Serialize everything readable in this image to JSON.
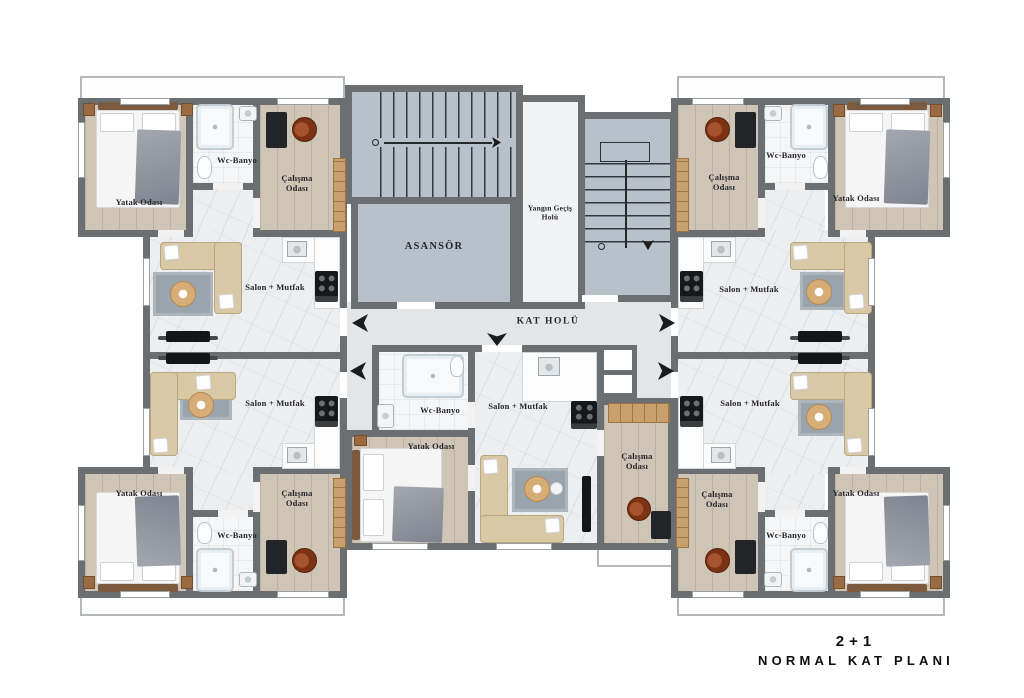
{
  "title": {
    "line1": "2+1",
    "line2": "NORMAL KAT PLANI"
  },
  "core": {
    "elevator": "ASANSÖR",
    "fire_escape_hall": "Yangın Geçiş Holü",
    "floor_hall": "KAT HOLÜ"
  },
  "room_labels": {
    "bedroom": "Yatak Odası",
    "bathroom": "Wc-Banyo",
    "study": "Çalışma Odası",
    "living_kitchen": "Salon + Mutfak"
  },
  "apartments": [
    {
      "position": "top-left",
      "type": "2+1",
      "rooms": [
        "Yatak Odası",
        "Wc-Banyo",
        "Çalışma Odası",
        "Salon + Mutfak"
      ]
    },
    {
      "position": "top-right",
      "type": "2+1",
      "rooms": [
        "Yatak Odası",
        "Wc-Banyo",
        "Çalışma Odası",
        "Salon + Mutfak"
      ]
    },
    {
      "position": "bottom-left",
      "type": "2+1",
      "rooms": [
        "Yatak Odası",
        "Wc-Banyo",
        "Çalışma Odası",
        "Salon + Mutfak"
      ]
    },
    {
      "position": "bottom-center",
      "type": "2+1",
      "rooms": [
        "Yatak Odası",
        "Wc-Banyo",
        "Çalışma Odası",
        "Salon + Mutfak"
      ]
    },
    {
      "position": "bottom-right",
      "type": "2+1",
      "rooms": [
        "Yatak Odası",
        "Wc-Banyo",
        "Çalışma Odası",
        "Salon + Mutfak"
      ]
    }
  ],
  "colors": {
    "wall": "#6b6f72",
    "stair_core_fill": "#b8c1c9",
    "corridor_floor": "#e3e5e8",
    "wood_floor": "#cec5b6",
    "marble_floor": "#edeeef",
    "sofa": "#d9c8a5",
    "rug": "#9aa4ad",
    "accent_wood": "#c9a06c",
    "title_text": "#0f0f10"
  }
}
